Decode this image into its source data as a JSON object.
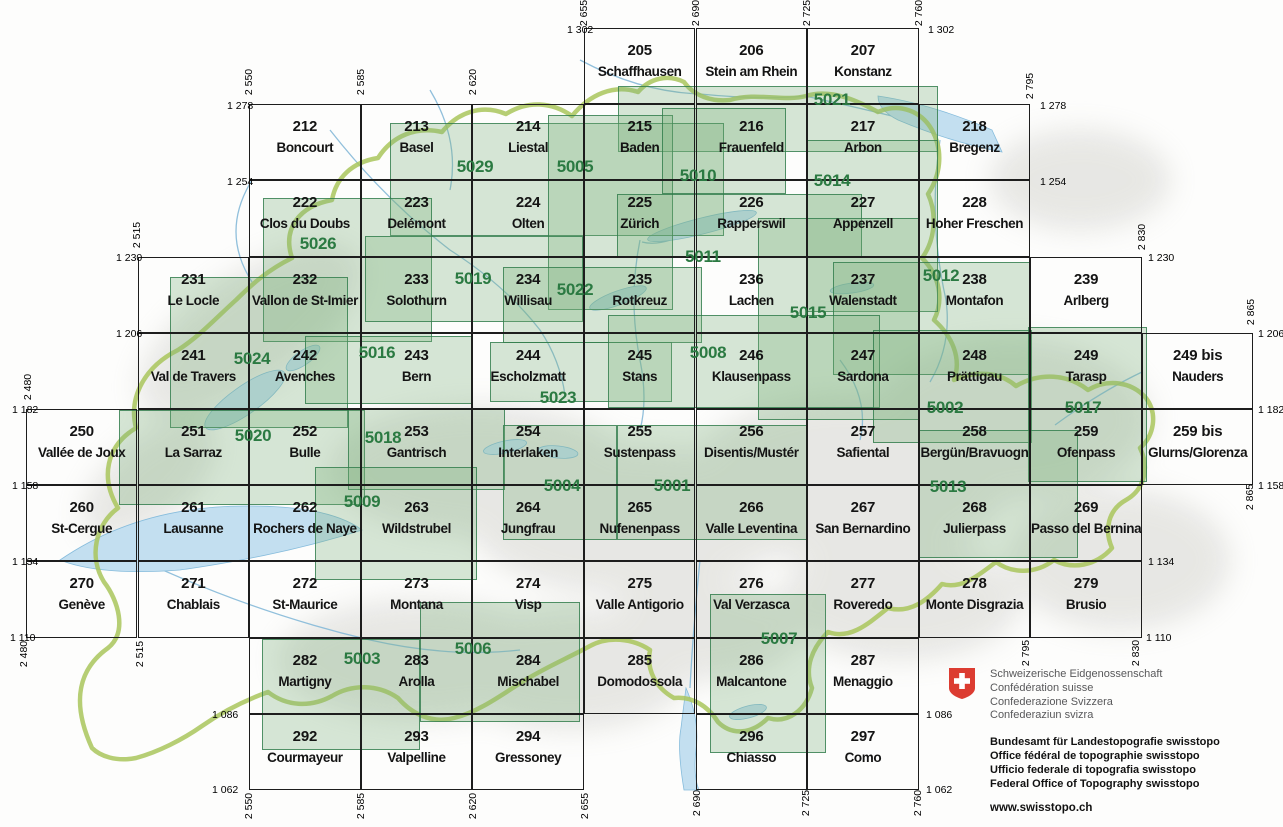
{
  "title": "Swiss national map 1:50 000 sheet index",
  "colors": {
    "sheet-green": "#2b7a42",
    "overlay-border": "#2e7b4acc",
    "overlay-fill": "#7cb07c4d",
    "swiss-red": "#dc3c31",
    "lake-blue": "#c3dff0",
    "lake-stroke": "#86bcdc",
    "border-green": "#a9c65c",
    "grid-black": "#1d1d1d"
  },
  "map": {
    "grid": {
      "col_base_x": 25.9,
      "col_w": 111.6,
      "row_base_y": 28,
      "row_h": 76.2
    },
    "cells": [
      {
        "num": "205",
        "name": "Schaffhausen",
        "col": 5,
        "row": 0
      },
      {
        "num": "206",
        "name": "Stein am Rhein",
        "col": 6,
        "row": 0
      },
      {
        "num": "207",
        "name": "Konstanz",
        "col": 7,
        "row": 0
      },
      {
        "num": "212",
        "name": "Boncourt",
        "col": 2,
        "row": 1
      },
      {
        "num": "213",
        "name": "Basel",
        "col": 3,
        "row": 1
      },
      {
        "num": "214",
        "name": "Liestal",
        "col": 4,
        "row": 1
      },
      {
        "num": "215",
        "name": "Baden",
        "col": 5,
        "row": 1
      },
      {
        "num": "216",
        "name": "Frauenfeld",
        "col": 6,
        "row": 1
      },
      {
        "num": "217",
        "name": "Arbon",
        "col": 7,
        "row": 1
      },
      {
        "num": "218",
        "name": "Bregenz",
        "col": 8,
        "row": 1
      },
      {
        "num": "222",
        "name": "Clos du Doubs",
        "col": 2,
        "row": 2
      },
      {
        "num": "223",
        "name": "Delémont",
        "col": 3,
        "row": 2
      },
      {
        "num": "224",
        "name": "Olten",
        "col": 4,
        "row": 2
      },
      {
        "num": "225",
        "name": "Zürich",
        "col": 5,
        "row": 2
      },
      {
        "num": "226",
        "name": "Rapperswil",
        "col": 6,
        "row": 2
      },
      {
        "num": "227",
        "name": "Appenzell",
        "col": 7,
        "row": 2
      },
      {
        "num": "228",
        "name": "Hoher Freschen",
        "col": 8,
        "row": 2
      },
      {
        "num": "231",
        "name": "Le Locle",
        "col": 1,
        "row": 3
      },
      {
        "num": "232",
        "name": "Vallon de St-Imier",
        "col": 2,
        "row": 3
      },
      {
        "num": "233",
        "name": "Solothurn",
        "col": 3,
        "row": 3
      },
      {
        "num": "234",
        "name": "Willisau",
        "col": 4,
        "row": 3
      },
      {
        "num": "235",
        "name": "Rotkreuz",
        "col": 5,
        "row": 3
      },
      {
        "num": "236",
        "name": "Lachen",
        "col": 6,
        "row": 3
      },
      {
        "num": "237",
        "name": "Walenstadt",
        "col": 7,
        "row": 3
      },
      {
        "num": "238",
        "name": "Montafon",
        "col": 8,
        "row": 3
      },
      {
        "num": "239",
        "name": "Arlberg",
        "col": 9,
        "row": 3
      },
      {
        "num": "241",
        "name": "Val de Travers",
        "col": 1,
        "row": 4
      },
      {
        "num": "242",
        "name": "Avenches",
        "col": 2,
        "row": 4
      },
      {
        "num": "243",
        "name": "Bern",
        "col": 3,
        "row": 4
      },
      {
        "num": "244",
        "name": "Escholzmatt",
        "col": 4,
        "row": 4
      },
      {
        "num": "245",
        "name": "Stans",
        "col": 5,
        "row": 4
      },
      {
        "num": "246",
        "name": "Klausenpass",
        "col": 6,
        "row": 4
      },
      {
        "num": "247",
        "name": "Sardona",
        "col": 7,
        "row": 4
      },
      {
        "num": "248",
        "name": "Prättigau",
        "col": 8,
        "row": 4
      },
      {
        "num": "249",
        "name": "Tarasp",
        "col": 9,
        "row": 4
      },
      {
        "num": "249 bis",
        "name": "Nauders",
        "col": 10,
        "row": 4
      },
      {
        "num": "250",
        "name": "Vallée de Joux",
        "col": 0,
        "row": 5
      },
      {
        "num": "251",
        "name": "La Sarraz",
        "col": 1,
        "row": 5
      },
      {
        "num": "252",
        "name": "Bulle",
        "col": 2,
        "row": 5
      },
      {
        "num": "253",
        "name": "Gantrisch",
        "col": 3,
        "row": 5
      },
      {
        "num": "254",
        "name": "Interlaken",
        "col": 4,
        "row": 5
      },
      {
        "num": "255",
        "name": "Sustenpass",
        "col": 5,
        "row": 5
      },
      {
        "num": "256",
        "name": "Disentis/Mustér",
        "col": 6,
        "row": 5
      },
      {
        "num": "257",
        "name": "Safiental",
        "col": 7,
        "row": 5
      },
      {
        "num": "258",
        "name": "Bergün/Bravuogn",
        "col": 8,
        "row": 5
      },
      {
        "num": "259",
        "name": "Ofenpass",
        "col": 9,
        "row": 5
      },
      {
        "num": "259 bis",
        "name": "Glurns/Glorenza",
        "col": 10,
        "row": 5
      },
      {
        "num": "260",
        "name": "St-Cergue",
        "col": 0,
        "row": 6
      },
      {
        "num": "261",
        "name": "Lausanne",
        "col": 1,
        "row": 6
      },
      {
        "num": "262",
        "name": "Rochers de Naye",
        "col": 2,
        "row": 6
      },
      {
        "num": "263",
        "name": "Wildstrubel",
        "col": 3,
        "row": 6
      },
      {
        "num": "264",
        "name": "Jungfrau",
        "col": 4,
        "row": 6
      },
      {
        "num": "265",
        "name": "Nufenenpass",
        "col": 5,
        "row": 6
      },
      {
        "num": "266",
        "name": "Valle Leventina",
        "col": 6,
        "row": 6
      },
      {
        "num": "267",
        "name": "San Bernardino",
        "col": 7,
        "row": 6
      },
      {
        "num": "268",
        "name": "Julierpass",
        "col": 8,
        "row": 6
      },
      {
        "num": "269",
        "name": "Passo del Bernina",
        "col": 9,
        "row": 6
      },
      {
        "num": "270",
        "name": "Genève",
        "col": 0,
        "row": 7
      },
      {
        "num": "271",
        "name": "Chablais",
        "col": 1,
        "row": 7
      },
      {
        "num": "272",
        "name": "St-Maurice",
        "col": 2,
        "row": 7
      },
      {
        "num": "273",
        "name": "Montana",
        "col": 3,
        "row": 7
      },
      {
        "num": "274",
        "name": "Visp",
        "col": 4,
        "row": 7
      },
      {
        "num": "275",
        "name": "Valle Antigorio",
        "col": 5,
        "row": 7
      },
      {
        "num": "276",
        "name": "Val Verzasca",
        "col": 6,
        "row": 7
      },
      {
        "num": "277",
        "name": "Roveredo",
        "col": 7,
        "row": 7
      },
      {
        "num": "278",
        "name": "Monte Disgrazia",
        "col": 8,
        "row": 7
      },
      {
        "num": "279",
        "name": "Brusio",
        "col": 9,
        "row": 7
      },
      {
        "num": "282",
        "name": "Martigny",
        "col": 2,
        "row": 8
      },
      {
        "num": "283",
        "name": "Arolla",
        "col": 3,
        "row": 8
      },
      {
        "num": "284",
        "name": "Mischabel",
        "col": 4,
        "row": 8
      },
      {
        "num": "285",
        "name": "Domodossola",
        "col": 5,
        "row": 8
      },
      {
        "num": "286",
        "name": "Malcantone",
        "col": 6,
        "row": 8
      },
      {
        "num": "287",
        "name": "Menaggio",
        "col": 7,
        "row": 8
      },
      {
        "num": "292",
        "name": "Courmayeur",
        "col": 2,
        "row": 9
      },
      {
        "num": "293",
        "name": "Valpelline",
        "col": 3,
        "row": 9
      },
      {
        "num": "294",
        "name": "Gressoney",
        "col": 4,
        "row": 9
      },
      {
        "num": "296",
        "name": "Chiasso",
        "col": 6,
        "row": 9
      },
      {
        "num": "297",
        "name": "Como",
        "col": 7,
        "row": 9
      }
    ],
    "composites": [
      {
        "num": "5021",
        "x1": 618,
        "y1": 86,
        "x2": 938,
        "y2": 152,
        "lx": 832,
        "ly": 100
      },
      {
        "num": "5029",
        "x1": 390,
        "y1": 123,
        "x2": 724,
        "y2": 236,
        "lx": 475,
        "ly": 167
      },
      {
        "num": "5005",
        "x1": 548,
        "y1": 115,
        "x2": 673,
        "y2": 310,
        "lx": 575,
        "ly": 167
      },
      {
        "num": "5010",
        "x1": 662,
        "y1": 108,
        "x2": 786,
        "y2": 194,
        "lx": 698,
        "ly": 176
      },
      {
        "num": "5014",
        "x1": 806,
        "y1": 140,
        "x2": 938,
        "y2": 312,
        "lx": 832,
        "ly": 181
      },
      {
        "num": "5026",
        "x1": 263,
        "y1": 198,
        "x2": 432,
        "y2": 342,
        "lx": 318,
        "ly": 244
      },
      {
        "num": "5011",
        "x1": 617,
        "y1": 194,
        "x2": 862,
        "y2": 257,
        "lx": 703,
        "ly": 257
      },
      {
        "num": "5019",
        "x1": 365,
        "y1": 236,
        "x2": 583,
        "y2": 322,
        "lx": 473,
        "ly": 279
      },
      {
        "num": "5022",
        "x1": 503,
        "y1": 267,
        "x2": 702,
        "y2": 343,
        "lx": 575,
        "ly": 290
      },
      {
        "num": "5015",
        "x1": 758,
        "y1": 218,
        "x2": 920,
        "y2": 420,
        "lx": 808,
        "ly": 313
      },
      {
        "num": "5012",
        "x1": 833,
        "y1": 262,
        "x2": 1030,
        "y2": 375,
        "lx": 941,
        "ly": 276
      },
      {
        "num": "5024",
        "x1": 170,
        "y1": 277,
        "x2": 348,
        "y2": 428,
        "lx": 252,
        "ly": 359
      },
      {
        "num": "5016",
        "x1": 305,
        "y1": 336,
        "x2": 472,
        "y2": 404,
        "lx": 377,
        "ly": 353
      },
      {
        "num": "5023",
        "x1": 490,
        "y1": 342,
        "x2": 672,
        "y2": 402,
        "lx": 558,
        "ly": 398
      },
      {
        "num": "5008",
        "x1": 608,
        "y1": 315,
        "x2": 880,
        "y2": 408,
        "lx": 708,
        "ly": 353
      },
      {
        "num": "5002",
        "x1": 873,
        "y1": 330,
        "x2": 1032,
        "y2": 443,
        "lx": 945,
        "ly": 408
      },
      {
        "num": "5017",
        "x1": 1028,
        "y1": 327,
        "x2": 1147,
        "y2": 482,
        "lx": 1083,
        "ly": 408
      },
      {
        "num": "5020",
        "x1": 119,
        "y1": 410,
        "x2": 365,
        "y2": 505,
        "lx": 253,
        "ly": 436
      },
      {
        "num": "5018",
        "x1": 348,
        "y1": 408,
        "x2": 505,
        "y2": 490,
        "lx": 383,
        "ly": 438
      },
      {
        "num": "5009",
        "x1": 315,
        "y1": 467,
        "x2": 477,
        "y2": 580,
        "lx": 362,
        "ly": 502
      },
      {
        "num": "5004",
        "x1": 503,
        "y1": 425,
        "x2": 617,
        "y2": 540,
        "lx": 562,
        "ly": 486
      },
      {
        "num": "5001",
        "x1": 617,
        "y1": 425,
        "x2": 807,
        "y2": 540,
        "lx": 672,
        "ly": 486
      },
      {
        "num": "5013",
        "x1": 918,
        "y1": 430,
        "x2": 1078,
        "y2": 558,
        "lx": 948,
        "ly": 487
      },
      {
        "num": "5003",
        "x1": 262,
        "y1": 639,
        "x2": 420,
        "y2": 750,
        "lx": 362,
        "ly": 659
      },
      {
        "num": "5006",
        "x1": 420,
        "y1": 602,
        "x2": 580,
        "y2": 722,
        "lx": 473,
        "ly": 649
      },
      {
        "num": "5007",
        "x1": 710,
        "y1": 594,
        "x2": 826,
        "y2": 753,
        "lx": 779,
        "ly": 639
      }
    ],
    "edge_labels": {
      "left": [
        {
          "t": "1 302",
          "x": 567,
          "y": 30
        },
        {
          "t": "1 278",
          "x": 227,
          "y": 106
        },
        {
          "t": "1 254",
          "x": 227,
          "y": 182
        },
        {
          "t": "1 230",
          "x": 116,
          "y": 258
        },
        {
          "t": "1 206",
          "x": 116,
          "y": 334
        },
        {
          "t": "1 182",
          "x": 12,
          "y": 410
        },
        {
          "t": "1 158",
          "x": 12,
          "y": 486
        },
        {
          "t": "1 134",
          "x": 12,
          "y": 562
        },
        {
          "t": "1 110",
          "x": 10,
          "y": 638
        },
        {
          "t": "1 086",
          "x": 212,
          "y": 715
        },
        {
          "t": "1 062",
          "x": 212,
          "y": 790
        }
      ],
      "right": [
        {
          "t": "1 302",
          "x": 928,
          "y": 30
        },
        {
          "t": "1 278",
          "x": 1040,
          "y": 106
        },
        {
          "t": "1 254",
          "x": 1040,
          "y": 182
        },
        {
          "t": "1 230",
          "x": 1148,
          "y": 258
        },
        {
          "t": "1 206",
          "x": 1258,
          "y": 334
        },
        {
          "t": "1 182",
          "x": 1258,
          "y": 410
        },
        {
          "t": "1 158",
          "x": 1258,
          "y": 486
        },
        {
          "t": "1 134",
          "x": 1148,
          "y": 562
        },
        {
          "t": "1 110",
          "x": 1146,
          "y": 638
        },
        {
          "t": "1 086",
          "x": 926,
          "y": 715
        },
        {
          "t": "1 062",
          "x": 926,
          "y": 790
        }
      ],
      "top": [
        {
          "t": "2 655",
          "x": 584,
          "y": 13
        },
        {
          "t": "2 690",
          "x": 696,
          "y": 13
        },
        {
          "t": "2 725",
          "x": 807,
          "y": 13
        },
        {
          "t": "2 760",
          "x": 919,
          "y": 13
        },
        {
          "t": "2 550",
          "x": 249,
          "y": 82
        },
        {
          "t": "2 585",
          "x": 361,
          "y": 82
        },
        {
          "t": "2 620",
          "x": 473,
          "y": 82
        },
        {
          "t": "2 795",
          "x": 1030,
          "y": 86
        },
        {
          "t": "2 515",
          "x": 137,
          "y": 235
        },
        {
          "t": "2 830",
          "x": 1142,
          "y": 237
        },
        {
          "t": "2 865",
          "x": 1251,
          "y": 312
        },
        {
          "t": "2 480",
          "x": 28,
          "y": 387
        }
      ],
      "bottom": [
        {
          "t": "2 480",
          "x": 24,
          "y": 654
        },
        {
          "t": "2 515",
          "x": 140,
          "y": 654
        },
        {
          "t": "2 865",
          "x": 1250,
          "y": 497
        },
        {
          "t": "2 795",
          "x": 1026,
          "y": 653
        },
        {
          "t": "2 830",
          "x": 1136,
          "y": 653
        },
        {
          "t": "2 550",
          "x": 249,
          "y": 806
        },
        {
          "t": "2 585",
          "x": 361,
          "y": 806
        },
        {
          "t": "2 620",
          "x": 473,
          "y": 806
        },
        {
          "t": "2 655",
          "x": 585,
          "y": 806
        },
        {
          "t": "2 690",
          "x": 697,
          "y": 803
        },
        {
          "t": "2 725",
          "x": 806,
          "y": 803
        },
        {
          "t": "2 760",
          "x": 918,
          "y": 803
        }
      ]
    }
  },
  "footer": {
    "confederation_lines": [
      "Schweizerische Eidgenossenschaft",
      "Confédération suisse",
      "Confederazione Svizzera",
      "Confederaziun svizra"
    ],
    "office_lines": [
      "Bundesamt für Landestopografie swisstopo",
      "Office fédéral de topographie swisstopo",
      "Ufficio federale di topografia swisstopo",
      "Federal Office of Topography swisstopo"
    ],
    "url": "www.swisstopo.ch"
  }
}
